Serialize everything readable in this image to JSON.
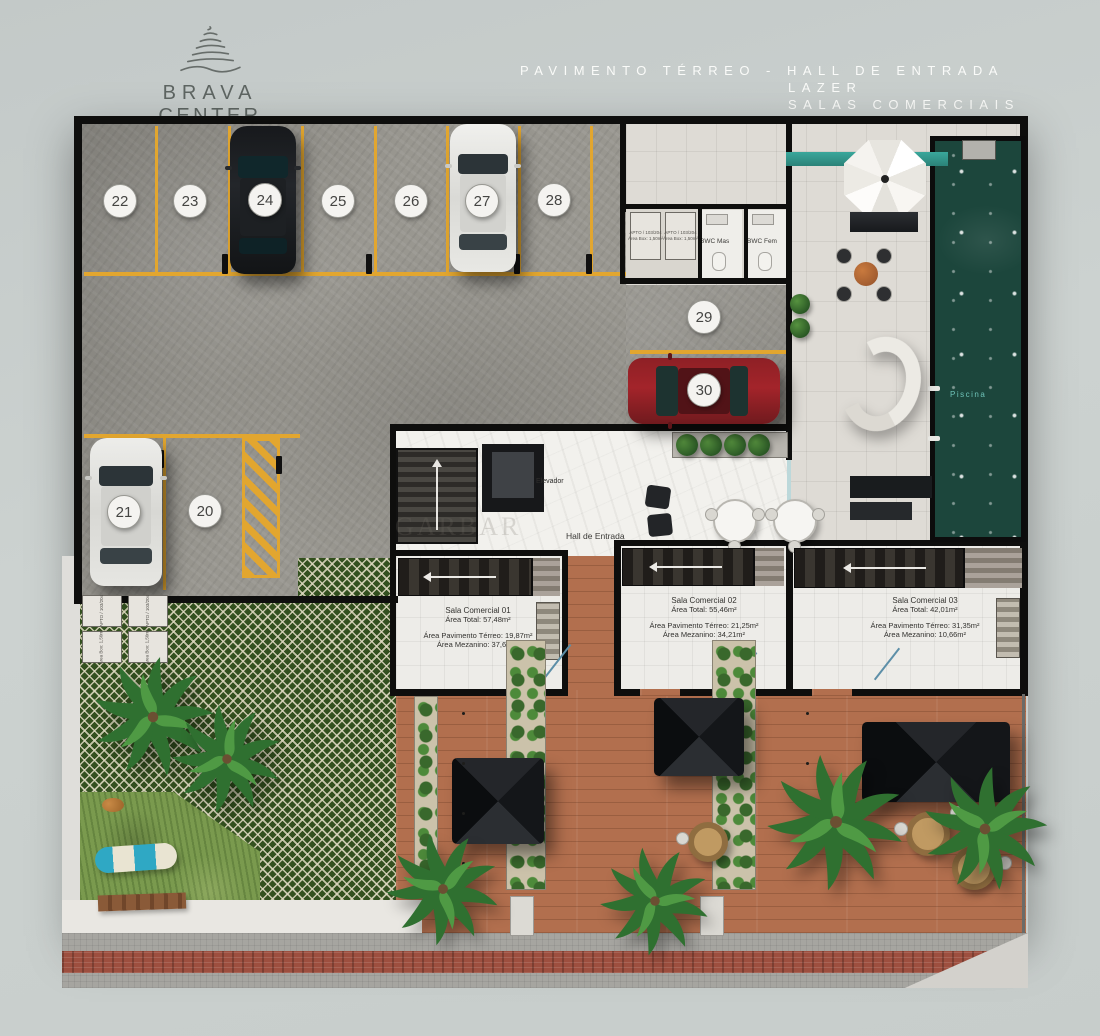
{
  "logo": {
    "name1": "BRAVA",
    "name2": "CENTER",
    "tagline": "Residence"
  },
  "title": {
    "line1": "PAVIMENTO TÉRREO - HALL DE ENTRADA",
    "line2": "LAZER",
    "line3": "SALAS COMERCIAIS"
  },
  "watermark": "GARBAR",
  "parking": {
    "top_row": [
      "22",
      "23",
      "24",
      "25",
      "26",
      "27",
      "28"
    ],
    "mid_spots": [
      "29",
      "30"
    ],
    "left_spots": [
      "20",
      "21"
    ]
  },
  "storage": {
    "box_label_line1": "APTO / 103/204",
    "box_label_line2": "Área Box: 1,50m²"
  },
  "rooms": {
    "bwc_mas": "BWC Mas",
    "bwc_fem": "BWC Fem",
    "elevador": "Elevador",
    "hall": "Hall de Entrada",
    "piscina": "Piscina"
  },
  "salas": [
    {
      "name": "Sala Comercial 01",
      "area_total": "Área Total: 57,48m²",
      "area_terreo": "Área Pavimento Térreo: 19,87m²",
      "area_mezanino": "Área Mezanino: 37,61m²"
    },
    {
      "name": "Sala Comercial 02",
      "area_total": "Área Total: 55,46m²",
      "area_terreo": "Área Pavimento Térreo: 21,25m²",
      "area_mezanino": "Área Mezanino: 34,21m²"
    },
    {
      "name": "Sala Comercial 03",
      "area_total": "Área Total: 42,01m²",
      "area_terreo": "Área Pavimento Térreo: 31,35m²",
      "area_mezanino": "Área Mezanino: 10,66m²"
    }
  ],
  "colors": {
    "line_yellow": "#e2a62f",
    "pool_green": "#1c463c",
    "wall_black": "#0e0e0d",
    "plaza_terracotta": "#b26f4e",
    "lattice_green": "#33501f"
  }
}
